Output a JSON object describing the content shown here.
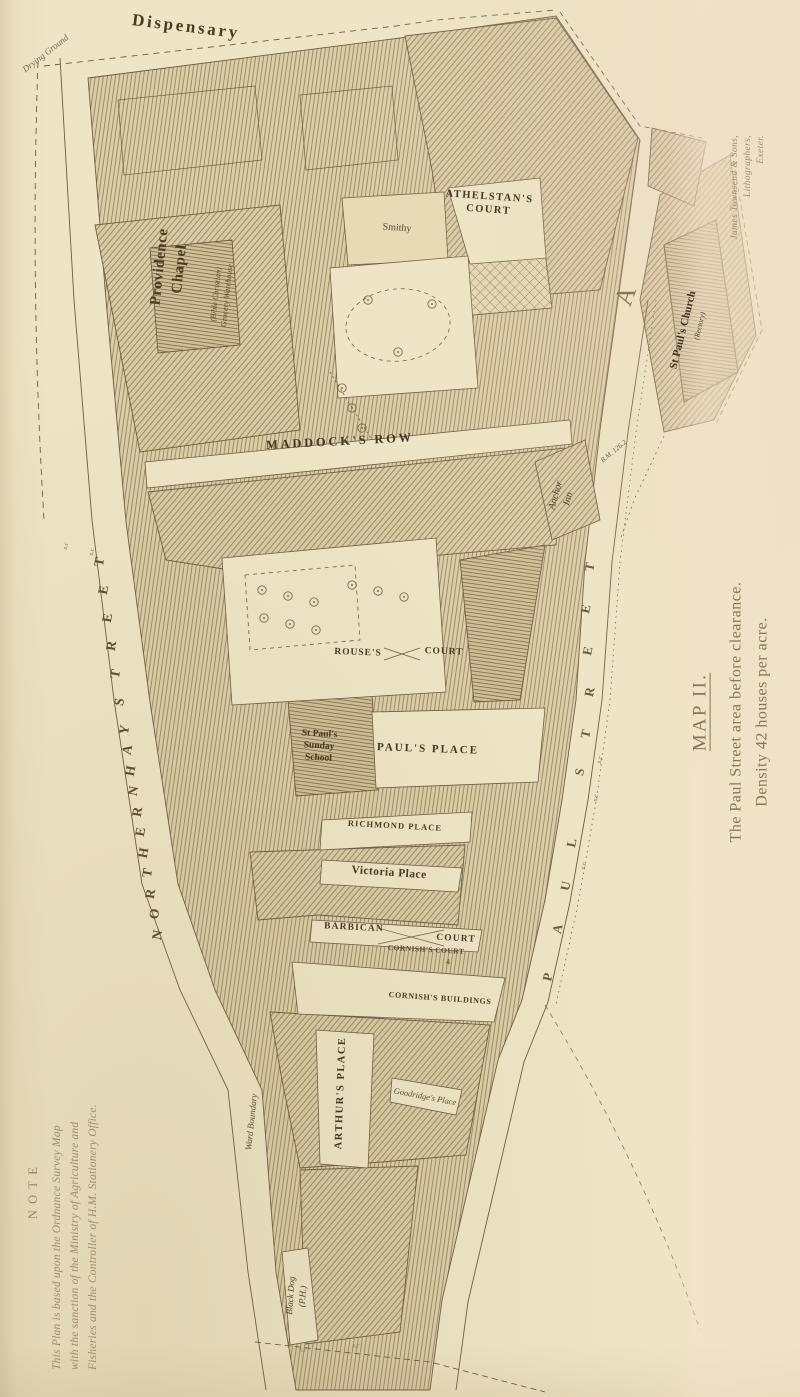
{
  "caption": {
    "heading": "MAP II.",
    "line1": "The Paul Street area before clearance.",
    "line2": "Density 42 houses per acre."
  },
  "imprint": {
    "line1": "James Townsend & Sons,",
    "line2": "Lithographers,",
    "line3": "Exeter."
  },
  "note": {
    "heading": "NOTE",
    "line1": "This Plan is based upon the Ordnance Survey Map",
    "line2": "with the sanction of the Ministry of Agriculture and",
    "line3": "Fisheries and the Controller of H.M. Stationery Office."
  },
  "colors": {
    "paper": "#efe5c6",
    "yard_shade": "#e7dbb4",
    "ink": "#6e5c40",
    "hatch": "#8d7a57",
    "block_fill": "#dccfa8",
    "label_ink": "#4f4028",
    "caption_ink": "#8b7453",
    "note_ink": "#9c8c6c"
  },
  "map_labels": [
    {
      "id": "drying-ground",
      "lines": [
        "Drying Ground"
      ],
      "x": 46,
      "y": 54,
      "rot": -38,
      "size": 9,
      "italic": true,
      "color": "#77684c"
    },
    {
      "id": "dispensary",
      "lines": [
        "Dispensary"
      ],
      "x": 186,
      "y": 27,
      "rot": 7,
      "size": 17,
      "weight": 700,
      "ls": 0.16,
      "color": "#4a3a24"
    },
    {
      "id": "providence-chapel",
      "lines": [
        "Providence",
        "Chapel"
      ],
      "x": 170,
      "y": 268,
      "rot": -84,
      "size": 15,
      "weight": 700,
      "ls": 0.04,
      "lh": 1.3,
      "color": "#4a3a24"
    },
    {
      "id": "providence-chapel-sub",
      "lines": [
        "(Bible Christian)",
        "Grocery Warehouse"
      ],
      "x": 222,
      "y": 295,
      "rot": -84,
      "size": 8,
      "italic": true,
      "lh": 1.35,
      "color": "#5d4c32"
    },
    {
      "id": "athelstans-court",
      "lines": [
        "ATHELSTAN'S",
        "COURT"
      ],
      "x": 489,
      "y": 204,
      "rot": 4,
      "size": 10.5,
      "weight": 700,
      "ls": 0.14,
      "lh": 1.2,
      "color": "#443622"
    },
    {
      "id": "smithy",
      "lines": [
        "Smithy"
      ],
      "x": 397,
      "y": 228,
      "rot": 4,
      "size": 10,
      "color": "#554631"
    },
    {
      "id": "maddocks-row",
      "lines": [
        "MADDOCK'S ROW"
      ],
      "x": 340,
      "y": 442,
      "rot": -3,
      "size": 12.5,
      "weight": 700,
      "ls": 0.22,
      "color": "#443622"
    },
    {
      "id": "rouses",
      "lines": [
        "ROUSE'S"
      ],
      "x": 358,
      "y": 653,
      "rot": 2,
      "size": 9.5,
      "weight": 700,
      "ls": 0.1,
      "color": "#4a3a26"
    },
    {
      "id": "rouses-court",
      "lines": [
        "COURT"
      ],
      "x": 444,
      "y": 652,
      "rot": 2,
      "size": 9.5,
      "weight": 700,
      "ls": 0.1,
      "color": "#4a3a26"
    },
    {
      "id": "st-pauls-sunday-school",
      "lines": [
        "St Paul's",
        "Sunday",
        "School"
      ],
      "x": 319,
      "y": 747,
      "rot": 3,
      "size": 9.5,
      "weight": 700,
      "lh": 1.25,
      "color": "#3f3220"
    },
    {
      "id": "pauls-place",
      "lines": [
        "PAUL'S PLACE"
      ],
      "x": 428,
      "y": 749,
      "rot": 2,
      "size": 11,
      "weight": 700,
      "ls": 0.18,
      "color": "#443622"
    },
    {
      "id": "richmond-place",
      "lines": [
        "RICHMOND PLACE"
      ],
      "x": 395,
      "y": 826,
      "rot": 3,
      "size": 8.5,
      "weight": 700,
      "ls": 0.12,
      "color": "#4a3a26"
    },
    {
      "id": "victoria-place",
      "lines": [
        "Victoria Place"
      ],
      "x": 389,
      "y": 873,
      "rot": 4,
      "size": 11.5,
      "weight": 700,
      "ls": 0.04,
      "color": "#4a3a26"
    },
    {
      "id": "barbican",
      "lines": [
        "BARBICAN"
      ],
      "x": 354,
      "y": 928,
      "rot": 3,
      "size": 9.5,
      "weight": 700,
      "ls": 0.12,
      "color": "#4a3a26"
    },
    {
      "id": "barbican-court",
      "lines": [
        "COURT"
      ],
      "x": 456,
      "y": 939,
      "rot": 3,
      "size": 9.5,
      "weight": 700,
      "ls": 0.12,
      "color": "#4a3a26"
    },
    {
      "id": "cornishs-court",
      "lines": [
        "CORNISH'S COURT"
      ],
      "x": 426,
      "y": 950,
      "rot": 3,
      "size": 7.5,
      "weight": 600,
      "ls": 0.06,
      "color": "#55452e"
    },
    {
      "id": "number-4",
      "lines": [
        "4"
      ],
      "x": 448,
      "y": 963,
      "rot": 0,
      "size": 8,
      "color": "#55452e"
    },
    {
      "id": "cornishs-buildings",
      "lines": [
        "CORNISH'S BUILDINGS"
      ],
      "x": 440,
      "y": 999,
      "rot": 4,
      "size": 8,
      "weight": 700,
      "ls": 0.08,
      "color": "#4a3a26"
    },
    {
      "id": "arthurs-place",
      "lines": [
        "ARTHUR'S PLACE"
      ],
      "x": 341,
      "y": 1093,
      "rot": -88,
      "size": 10.5,
      "weight": 700,
      "ls": 0.14,
      "color": "#443622"
    },
    {
      "id": "ward-boundary",
      "lines": [
        "Ward Boundary"
      ],
      "x": 252,
      "y": 1122,
      "rot": -84,
      "size": 9,
      "italic": true,
      "color": "#5d4c32"
    },
    {
      "id": "goodridges-place",
      "lines": [
        "Goodridge's Place"
      ],
      "x": 425,
      "y": 1097,
      "rot": 11,
      "size": 8.5,
      "italic": true,
      "color": "#5d4c32"
    },
    {
      "id": "black-dog-ph",
      "lines": [
        "Black Dog",
        "(P.H.)"
      ],
      "x": 297,
      "y": 1296,
      "rot": -86,
      "size": 9,
      "italic": true,
      "lh": 1.3,
      "color": "#4f4028"
    },
    {
      "id": "st-pauls-church",
      "lines": [
        "St Paul's Church"
      ],
      "x": 683,
      "y": 330,
      "rot": -76,
      "size": 11,
      "weight": 700,
      "color": "#3f3220"
    },
    {
      "id": "rectory",
      "lines": [
        "(Rectory)"
      ],
      "x": 700,
      "y": 326,
      "rot": -76,
      "size": 7.5,
      "italic": true,
      "color": "#55452e"
    },
    {
      "id": "anchor-inn",
      "lines": [
        "Anchor",
        "Inn"
      ],
      "x": 562,
      "y": 497,
      "rot": -74,
      "size": 10,
      "italic": true,
      "lh": 1.3,
      "color": "#4f4028"
    },
    {
      "id": "bm-126",
      "lines": [
        "B.M. 126.2"
      ],
      "x": 614,
      "y": 452,
      "rot": -40,
      "size": 7,
      "italic": true,
      "color": "#6c5b3f"
    },
    {
      "id": "letter-a-ornate",
      "lines": [
        "A"
      ],
      "x": 626,
      "y": 296,
      "rot": -70,
      "size": 26,
      "color": "#8a7757"
    },
    {
      "id": "sc-1",
      "lines": [
        "s.c"
      ],
      "x": 66,
      "y": 546,
      "rot": -80,
      "size": 6.5,
      "italic": true,
      "color": "#7a6848"
    },
    {
      "id": "sc-2",
      "lines": [
        "s.c"
      ],
      "x": 92,
      "y": 552,
      "rot": -80,
      "size": 6.5,
      "italic": true,
      "color": "#7a6848"
    },
    {
      "id": "sc-3",
      "lines": [
        "s.c"
      ],
      "x": 596,
      "y": 798,
      "rot": -78,
      "size": 6.5,
      "italic": true,
      "color": "#7a6848"
    },
    {
      "id": "sc-4",
      "lines": [
        "s.c"
      ],
      "x": 600,
      "y": 760,
      "rot": -78,
      "size": 6.5,
      "italic": true,
      "color": "#7a6848"
    },
    {
      "id": "sc-5",
      "lines": [
        "s.c"
      ],
      "x": 584,
      "y": 866,
      "rot": -78,
      "size": 6.5,
      "italic": true,
      "color": "#7a6848"
    },
    {
      "id": "sc-6",
      "lines": [
        "s.c"
      ],
      "x": 303,
      "y": 1350,
      "rot": 4,
      "size": 6.5,
      "italic": true,
      "color": "#7a6848"
    },
    {
      "id": "sc-7",
      "lines": [
        "s.c"
      ],
      "x": 356,
      "y": 1346,
      "rot": 4,
      "size": 6.5,
      "italic": true,
      "color": "#7a6848"
    }
  ],
  "street_letter_runs": [
    {
      "id": "paul-street",
      "name": "PAUL STREET",
      "rot": -78,
      "size": 13,
      "color": "#6e5c40",
      "letters": [
        [
          "P",
          548,
          977
        ],
        [
          "A",
          558,
          929
        ],
        [
          "U",
          566,
          886
        ],
        [
          "L",
          572,
          843
        ],
        [
          "S",
          580,
          772
        ],
        [
          "T",
          586,
          734
        ],
        [
          "R",
          590,
          692
        ],
        [
          "E",
          588,
          651
        ],
        [
          "E",
          586,
          609
        ],
        [
          "T",
          590,
          567
        ]
      ]
    },
    {
      "id": "northernhay-street",
      "name": "NORTHERNHAY STREET",
      "rot": -80,
      "size": 13.5,
      "color": "#5e4d33",
      "letters": [
        [
          "T",
          100,
          562
        ],
        [
          "E",
          104,
          590
        ],
        [
          "E",
          108,
          618
        ],
        [
          "R",
          112,
          646
        ],
        [
          "T",
          116,
          674
        ],
        [
          "S",
          120,
          702
        ],
        [
          "Y",
          125,
          730
        ],
        [
          "A",
          128,
          750
        ],
        [
          "H",
          131,
          771
        ],
        [
          "N",
          134,
          791
        ],
        [
          "R",
          138,
          812
        ],
        [
          "E",
          141,
          832
        ],
        [
          "H",
          144,
          853
        ],
        [
          "T",
          148,
          873
        ],
        [
          "R",
          151,
          894
        ],
        [
          "O",
          155,
          914
        ],
        [
          "N",
          158,
          935
        ]
      ]
    }
  ]
}
